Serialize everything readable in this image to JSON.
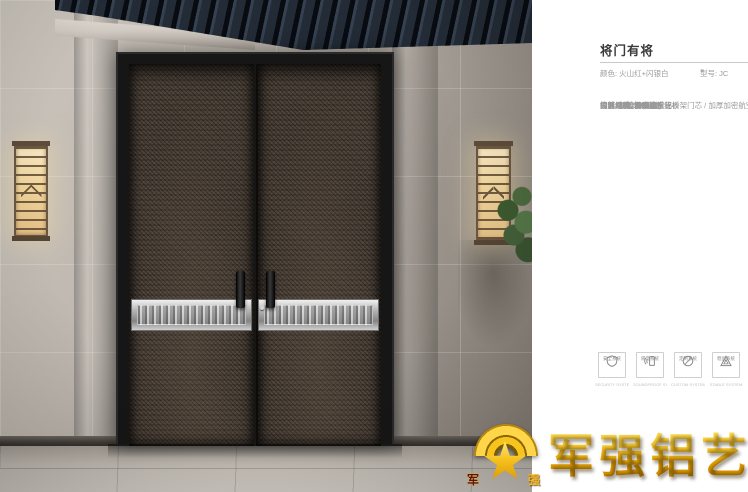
{
  "header": {
    "title": "将门有将",
    "color_label": "颜色: 火山红+闪银白",
    "model_icon": "♥",
    "model_label": "型号: JC"
  },
  "specs": [
    "设计风格: 新中式",
    "工艺结构: 极窄边系统",
    "门扇厚度: 100MM",
    "门面材质: 精雕铝板",
    "门框材质: SECC板",
    "背板材质: 多层实木背板",
    "内结构: 3.5MM太空铝桥架门芯 / 加厚加密航空铝蜂窝",
    "铰链: 明铰链暗装",
    "锁具: 智能锁(选配)",
    "拉手: 精雕滑盖拉手"
  ],
  "features": [
    {
      "icon": "shield-icon",
      "label": "安全系统",
      "caption": "SECURITY SYSTEM"
    },
    {
      "icon": "soundproof-icon",
      "label": "隔音系统",
      "caption": "SOUNDPROOF SYSTEM"
    },
    {
      "icon": "craft-icon",
      "label": "定制系统",
      "caption": "CUSTOM SYSTEM"
    },
    {
      "icon": "stable-icon",
      "label": "稳固系统",
      "caption": "STABLE SYSTEM"
    }
  ],
  "logo": {
    "brand": "军强铝艺",
    "left_char": "军",
    "right_char": "强"
  },
  "colors": {
    "accent_gold": "#f0b000",
    "title_text": "#3a3a3a",
    "spec_text": "#9a9a9a",
    "door_leaf": "#493f36",
    "door_frame": "#161616",
    "band_silver": "#c7c7c7",
    "eaves_navy": "#232b36"
  }
}
